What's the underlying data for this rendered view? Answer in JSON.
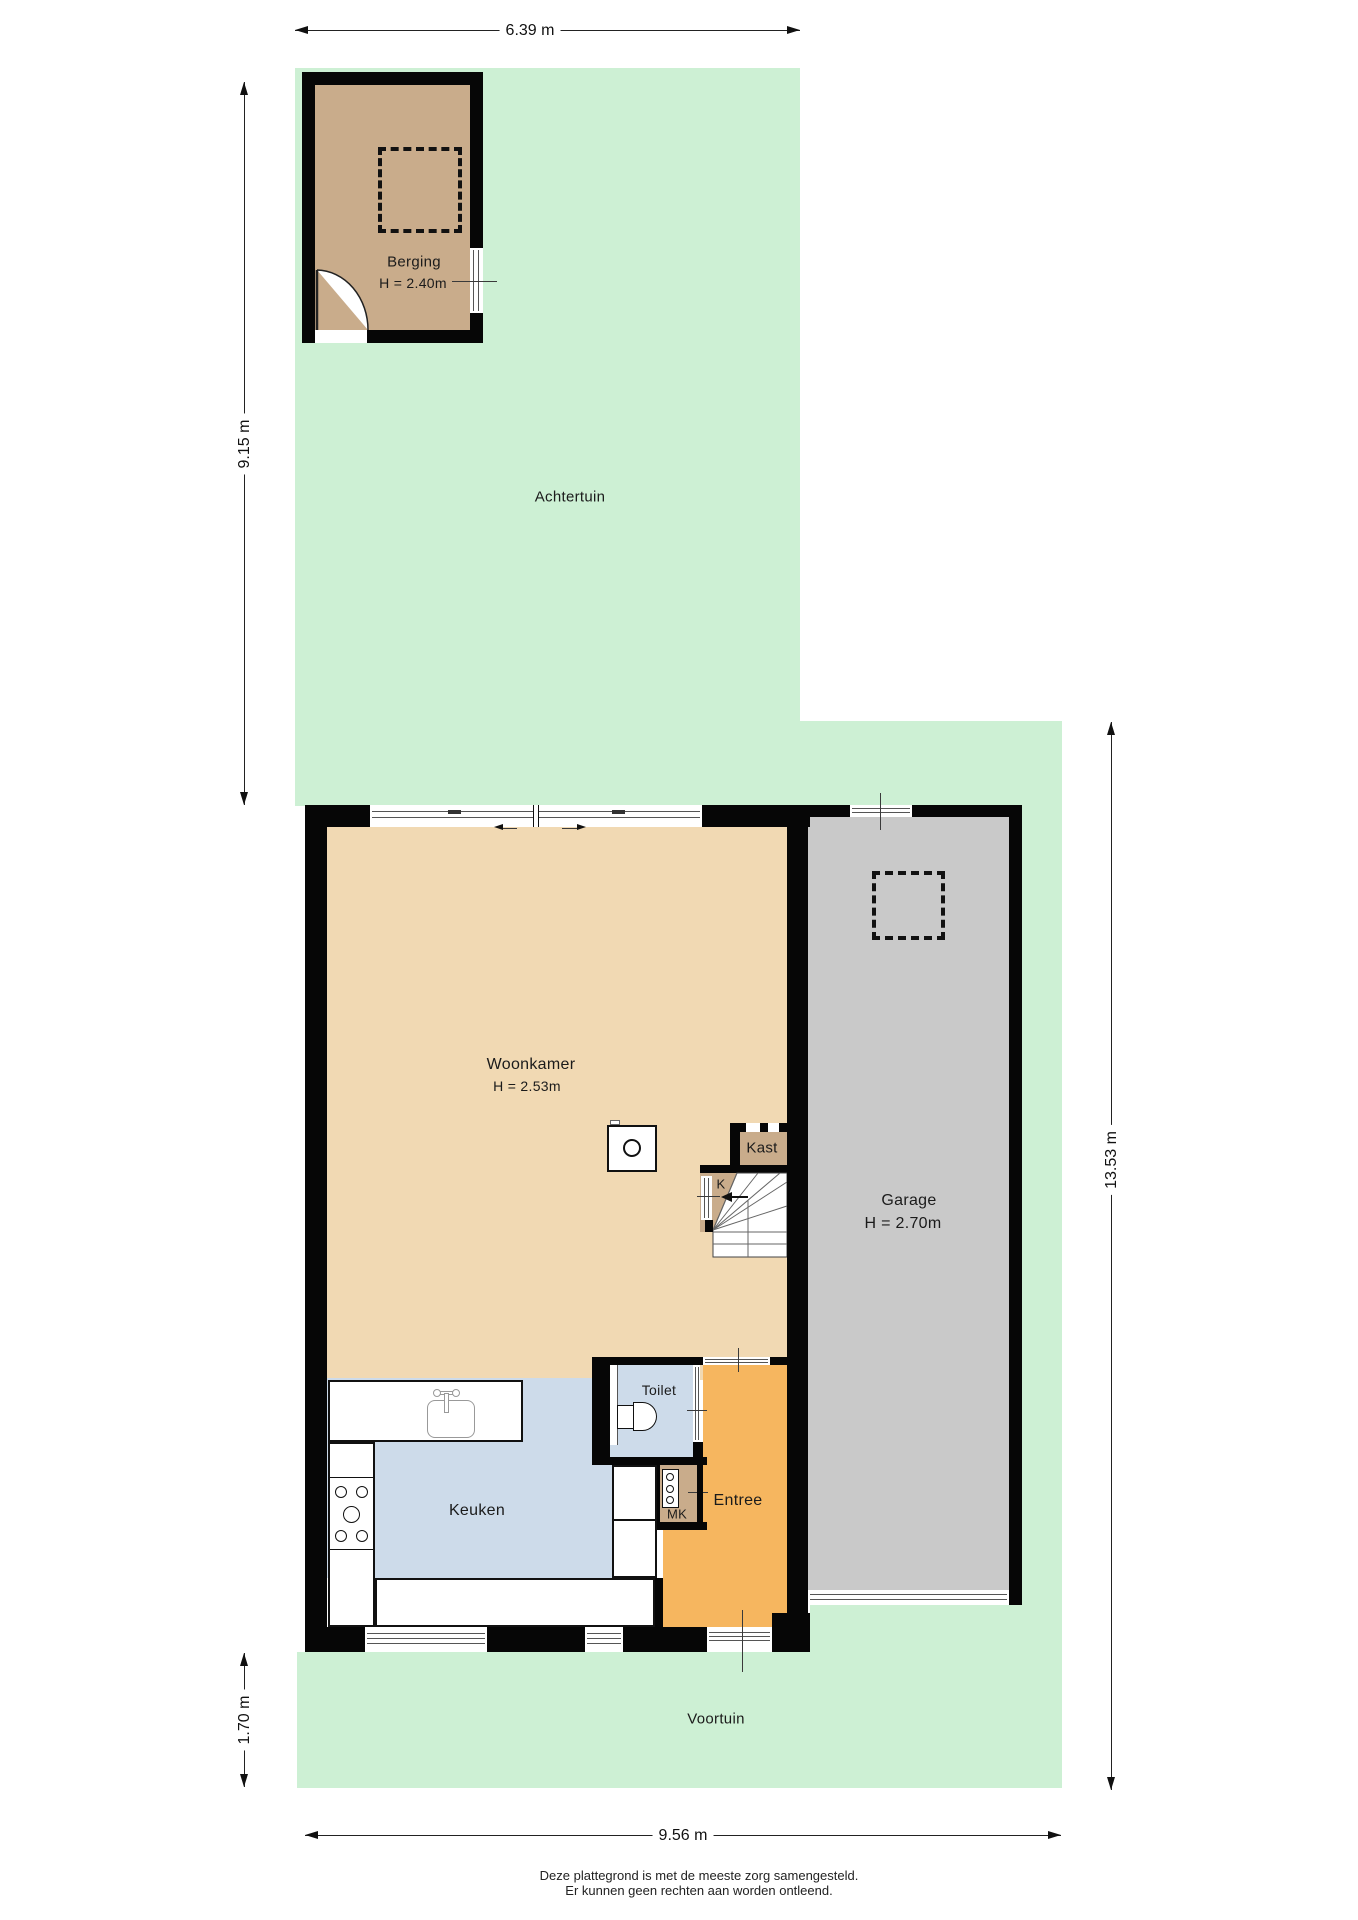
{
  "plan": {
    "gardens": {
      "achtertuin": "Achtertuin",
      "voortuin": "Voortuin"
    },
    "rooms": {
      "berging": {
        "name": "Berging",
        "height": "H = 2.40m"
      },
      "woonkamer": {
        "name": "Woonkamer",
        "height": "H = 2.53m"
      },
      "garage": {
        "name": "Garage",
        "height": "H = 2.70m"
      },
      "kast": {
        "name": "Kast"
      },
      "k": {
        "name": "K"
      },
      "toilet": {
        "name": "Toilet"
      },
      "mk": {
        "name": "MK"
      },
      "keuken": {
        "name": "Keuken"
      },
      "entree": {
        "name": "Entree"
      }
    },
    "dims": {
      "top": "6.39 m",
      "left_upper": "9.15 m",
      "left_lower": "1.70 m",
      "right": "13.53 m",
      "bottom": "9.56 m"
    },
    "footer": {
      "line1": "Deze plattegrond is met de meeste zorg samengesteld.",
      "line2": "Er kunnen geen rechten aan worden ontleend."
    },
    "colors": {
      "garden": "#cdf0d4",
      "floor": "#f1d9b3",
      "kitchen": "#cddbea",
      "entreecol": "#f6b65f",
      "garagecol": "#c9c9c9",
      "storage": "#c9ac8b",
      "wall": "#060606"
    }
  }
}
